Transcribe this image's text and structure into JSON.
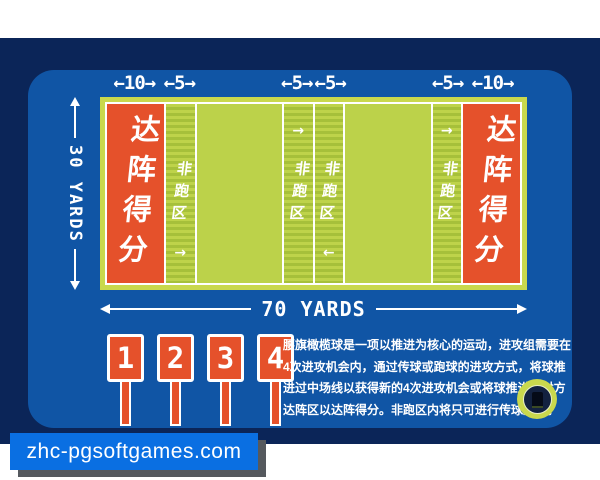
{
  "measurements": {
    "top_labels": [
      "←10→",
      "←5→",
      "←5→",
      "←5→",
      "←5→",
      "←10→"
    ],
    "left_label": "30 YARDS",
    "bottom_label": "70 YARDS"
  },
  "field": {
    "end_zone_left_label": "达阵得分",
    "end_zone_right_label": "达阵得分",
    "no_run_labels": [
      "非跑区",
      "非跑区",
      "非跑区",
      "非跑区"
    ],
    "zone_arrows": [
      "→",
      "→",
      "←",
      "→"
    ]
  },
  "down_markers": {
    "labels": [
      "1",
      "2",
      "3",
      "4"
    ]
  },
  "description": {
    "lines": [
      "腰旗橄榄球是一项以推进为核心的运动，进攻组需要在",
      "4次进攻机会内，通过传球或跑球的进攻方式，将球推",
      "进过中场线以获得新的4次进攻机会或将球推进至对方",
      "达阵区以达阵得分。非跑区内将只可进行传球进攻。"
    ]
  },
  "watermark": {
    "text": "zhc-pgsoftgames.com"
  },
  "colors": {
    "background_navy": "#0b2558",
    "card_blue": "#1055a5",
    "field_frame_green": "#c9d84d",
    "field_green": "#bcd24a",
    "stripe_green_dark": "#a6c03a",
    "end_zone_orange": "#e5512b",
    "watermark_blue": "#0a6fe2",
    "text_white": "#ffffff"
  }
}
